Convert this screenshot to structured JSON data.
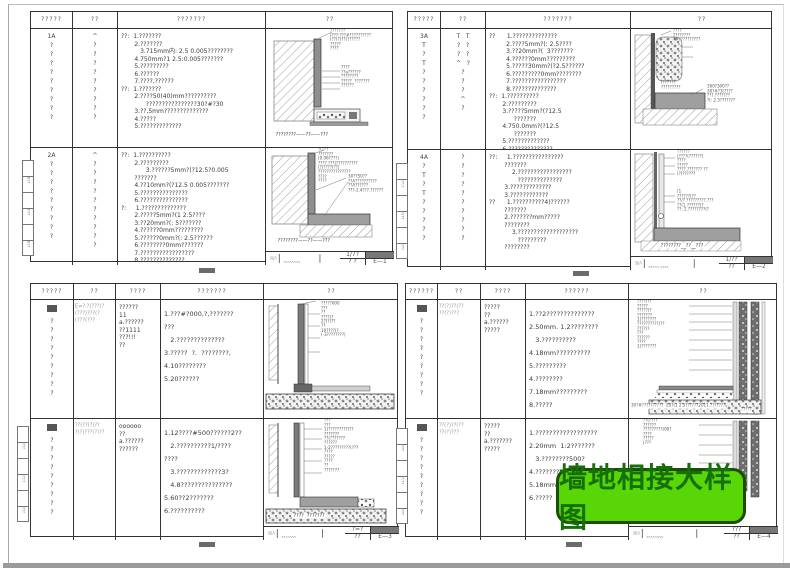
{
  "banner": {
    "text": "墙地相接大样图",
    "bg": "#58d606",
    "border": "#1d4d00",
    "text_color": "#15700a"
  },
  "panels": [
    {
      "headers": [
        "?????",
        "??",
        "???????",
        "??"
      ],
      "tabs": [
        "",
        "E??",
        "",
        "FY?",
        "",
        "E??"
      ],
      "titleblock": {
        "logo": "图A",
        "name1": "????????",
        "name2": "????????",
        "scale": "1/7?",
        "scale2": "?  ?",
        "page": "E—1"
      },
      "rows": [
        {
          "col1": [
            "1A",
            "?",
            "?",
            "?",
            "?",
            "?",
            "?",
            "?",
            "?",
            "?"
          ],
          "col2": [
            "^",
            "?",
            "?",
            "?",
            "?",
            "?",
            "?",
            "?",
            "?",
            "?"
          ],
          "notes": [
            "??:  1.???????",
            "       2.???????",
            "          3.715mm内: 2.5 0.005????????",
            "       4.750mm?1 2.5:0.005???????",
            "       5.?????????",
            "       6.??????",
            "       7.????,??????",
            "??:  1.???????",
            "       2.????50(40)mm??????????",
            "             ????????????????30?#?30",
            "       3.??,5mm??????????????",
            "       4.?????",
            "       5.?????????????"
          ],
          "labels1": [
            "???????",
            "(???:???#??????????",
            "(??(?)??)??????",
            "?????",
            "????"
          ],
          "labels2": [
            "????",
            "??a??????",
            "????????",
            "?????  ???????",
            "??????"
          ],
          "caption": "????????——??——???"
        },
        {
          "col1": [
            "2A",
            "?",
            "?",
            "?",
            "?",
            "?",
            "?",
            "?",
            "?",
            "?"
          ],
          "col2": [
            "^",
            "?",
            "?",
            "?",
            "?",
            "?",
            "?",
            "?",
            "?",
            "?",
            "?"
          ],
          "notes": [
            "??:  1.??????????",
            "       2.?????????",
            "             3.??????5mm?(?12.5?0.005",
            "       ???????",
            "       4.??10mm?(?12.5 0.005???????",
            "       5.???????????????",
            "       6.???????????????",
            "?:     1.??????????????",
            "       2.?????5mm?(1 2.5????",
            "       3.??20mm?(: 5???????",
            "       4.??????0mm?????????",
            "       5.??????0mm?(: 2.5??????",
            "       6.????????0mm???????",
            "       7.?????????????????",
            "       8.??????????????"
          ],
          "labels1": [
            "?(???",
            "???????",
            "(0.06????)",
            "????.???(??????????",
            "(?)????(??)",
            "???????????????",
            "????",
            "????"
          ],
          "labels2": [
            "30??50??",
            "??A??????????",
            "??A??????",
            "???-2.4???.??????"
          ],
          "caption": "????????——??——???"
        }
      ]
    },
    {
      "headers": [
        "?????",
        "??",
        "???????",
        "??"
      ],
      "tabs": [
        "",
        "??;?",
        "",
        "?(??",
        "",
        "???"
      ],
      "titleblock": {
        "logo": "图A",
        "name1": "????? ????",
        "name2": "????? ????",
        "scale": "1/??",
        "scale2": "??",
        "page": "E—2"
      },
      "rows": [
        {
          "col1": [
            "3A",
            "T",
            "?",
            "T",
            "?",
            "?",
            "?",
            "?",
            "?",
            "?"
          ],
          "col2": [
            "T   T",
            "?   ?",
            "?   ?",
            "^   ?",
            "?",
            "?",
            "?",
            "^",
            "?"
          ],
          "notes": [
            "??      1.??????????????",
            "         2.????5mm?(: 2.5????",
            "         3.??20mm?(  3???????",
            "         4.??????0mm?????????",
            "         5.?????30mm?(?2.5??????",
            "         6.?????????0mm????????",
            "         7.?????????????????",
            "         8.??????????????",
            "??:  1.??????????",
            "       2.?????????",
            "       3.?????5mm?(?12.5",
            "             ???????",
            "       4.750.0mm?(?12.5",
            "             ???????",
            "       5.?????????????",
            "       6.??????????????"
          ],
          "labels1": [
            "????",
            "????????",
            "?#??????????"
          ],
          "labels2": [
            "300?300??",
            "30?#?3(????",
            "???.???????",
            "?(: 2.5???????"
          ],
          "labels3": [
            "(??????",
            "?????????"
          ],
          "caption": ""
        },
        {
          "col1": [
            "4A",
            "?",
            "T",
            "?",
            "T",
            "?",
            "?",
            "?",
            "?",
            "?"
          ],
          "col2": [
            "?",
            "?",
            "?",
            "?",
            "?",
            "?",
            "?",
            "?",
            "?",
            "?"
          ],
          "notes": [
            "??:     1.????????????????",
            "        ???????",
            "            2.?????????????????",
            "               ??????????????",
            "        3.?????????????",
            "        3.????????????",
            "??      1.??????????4)??????",
            "        ???????",
            "        2.???????mm?????",
            "        ????????",
            "            3.???????????????????",
            "               ?????????",
            "        ????????"
          ],
          "labels1": [
            "??????",
            "(????(??????)",
            "????",
            "?????",
            "????.??????? ??",
            "(?)??????"
          ],
          "labels2": [
            "(1",
            "??????(??",
            "??/? ?????????.???",
            "??(1 ??????(?",
            "??: 2.????????(?"
          ],
          "caption": "????????__??__???"
        }
      ]
    },
    {
      "headers": [
        "?????",
        "??",
        "????",
        "???????",
        "??"
      ],
      "tabs": [
        "",
        "???",
        "",
        "??;?",
        "",
        "???"
      ],
      "titleblock": {
        "logo": "图A",
        "name1": "???????",
        "name2": "????????",
        "scale": "?=?",
        "scale2": "??",
        "page": "E—3"
      },
      "rows": [
        {
          "col1": [
            "?",
            "?",
            "?",
            "?",
            "?",
            "?",
            "?",
            "?",
            "?"
          ],
          "col2": [
            "E=?.?(???(?",
            "(???)???(?",
            "(???(???"
          ],
          "col3": [
            "??????",
            "",
            "11",
            "",
            "a.??????",
            "??1111",
            "???!!!",
            "??"
          ],
          "notes": [
            "1.???#?000,?,???????",
            "???",
            "   2.??????????????",
            "3.?????  ?.  ????????,",
            "4.10????????",
            "5.20??????"
          ],
          "labels1": [
            "?????000",
            "???",
            "??",
            "????(?",
            "2?(?(??",
            "??",
            "10????(?",
            "(-3????????)"
          ],
          "caption": ""
        },
        {
          "col1": [
            "?",
            "?",
            "?",
            "?",
            "?",
            "?",
            "?",
            "?",
            "?"
          ],
          "col2": [
            "??(??(?)??",
            "?(?)???(?)??"
          ],
          "col3": [
            "oooooo",
            "",
            "??",
            "",
            "a.??????",
            "??????"
          ],
          "notes": [
            "1.12????#500??????2??",
            "   2.??????????1/????",
            "????",
            "   3.?????????????3?",
            "   4.8???????????????",
            "5.60??2???????",
            "6.??????????"
          ],
          "labels1": [
            "???",
            "???",
            "1(?????????(??",
            "???????",
            "??(???????",
            "??????",
            "1-2?????????(???",
            "????",
            "?????",
            "????",
            "??",
            "???????"
          ],
          "caption": "????  ???????"
        }
      ]
    },
    {
      "headers": [
        "??????",
        "??",
        "????",
        "??????",
        "??"
      ],
      "tabs": [
        "",
        "???",
        "",
        "?;??",
        "",
        "???"
      ],
      "titleblock": {
        "logo": "图A",
        "name1": "????????",
        "name2": "",
        "scale": "???",
        "scale2": "??",
        "page": "E—4"
      },
      "rows": [
        {
          "col1": [
            "?",
            "?",
            "?",
            "?",
            "?",
            "?",
            "?",
            "?",
            "?"
          ],
          "col2": [
            "??(?)??(??",
            "??(?)???"
          ],
          "col3": [
            "?????",
            "",
            "??",
            "",
            "a.??????",
            "?????"
          ],
          "notes": [
            "1.??2??????????????",
            "2.50mm. 1.2????????",
            "   3.??????????",
            "4.18mm??????????",
            "5.?????????",
            "4.????????",
            "7.18mm?????????",
            "8.?????"
          ],
          "labels1": [
            "????(??",
            "?????",
            "?????(?",
            "???????",
            "1(???????",
            "??????????(??",
            "????(?",
            "???",
            "??????",
            "????",
            "1(???????"
          ],
          "labels2": [
            "?????"
          ],
          "bottom_labels": [
            "30?#??????????  20?(1 2.5??????",
            "2011.???????"
          ],
          "caption": ""
        },
        {
          "col1": [
            "?",
            "?",
            "?",
            "?",
            "?",
            "?",
            "?",
            "?",
            "?"
          ],
          "col2": [
            "??(?)??(??",
            "??(?)???"
          ],
          "col3": [
            "?????",
            "",
            "??",
            "",
            "a.???????",
            "?????"
          ],
          "notes": [
            "1.??????????????????",
            "2.20mm  1:2???????",
            "   3.????????500?",
            "4.????????",
            "5.18mm??????????",
            "6.?????"
          ],
          "labels1": [
            "??(????",
            "??????",
            "?????????(00?",
            "????",
            "?????",
            "(???"
          ],
          "caption": ""
        }
      ]
    }
  ]
}
